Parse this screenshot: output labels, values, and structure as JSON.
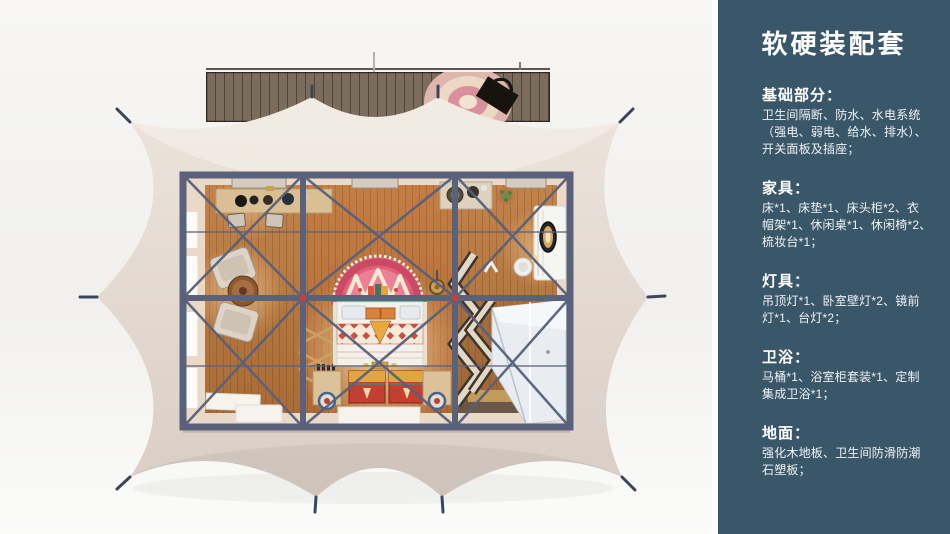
{
  "sidebar": {
    "bg_color": "#3a5669",
    "text_color": "#eef3f6",
    "title": "软硬装配套",
    "sections": [
      {
        "heading": "基础部分：",
        "lines": [
          "卫生间隔断、防水、水电系统",
          "（强电、弱电、给水、排水）、",
          "开关面板及插座；"
        ]
      },
      {
        "heading": "家具：",
        "lines": [
          "床*1、床垫*1、床头柜*2、衣",
          "帽架*1、休闲桌*1、休闲椅*2、",
          "梳妆台*1；"
        ]
      },
      {
        "heading": "灯具：",
        "lines": [
          "吊顶灯*1、卧室壁灯*2、镜前",
          "灯*1、台灯*2；"
        ]
      },
      {
        "heading": "卫浴：",
        "lines": [
          "马桶*1、浴室柜套装*1、定制",
          "集成卫浴*1；"
        ]
      },
      {
        "heading": "地面：",
        "lines": [
          "强化木地板、卫生间防滑防潮",
          "石塑板；"
        ]
      }
    ]
  },
  "illustration": {
    "subject": "glamping-tent-top-view-render",
    "colors": {
      "canvas": "#e5dcd4",
      "canvas_dark": "#d8cec6",
      "frame": "#59627a",
      "wood_floor": "#bb7d44",
      "deck_wood": "#7b6c5d",
      "headboard_pink": "#e0607a",
      "chest_red": "#c23f31",
      "gold": "#e2a53f",
      "fixture_white": "#e9edf2",
      "connector_red": "#c64038",
      "background": "#f3f2f0"
    }
  }
}
